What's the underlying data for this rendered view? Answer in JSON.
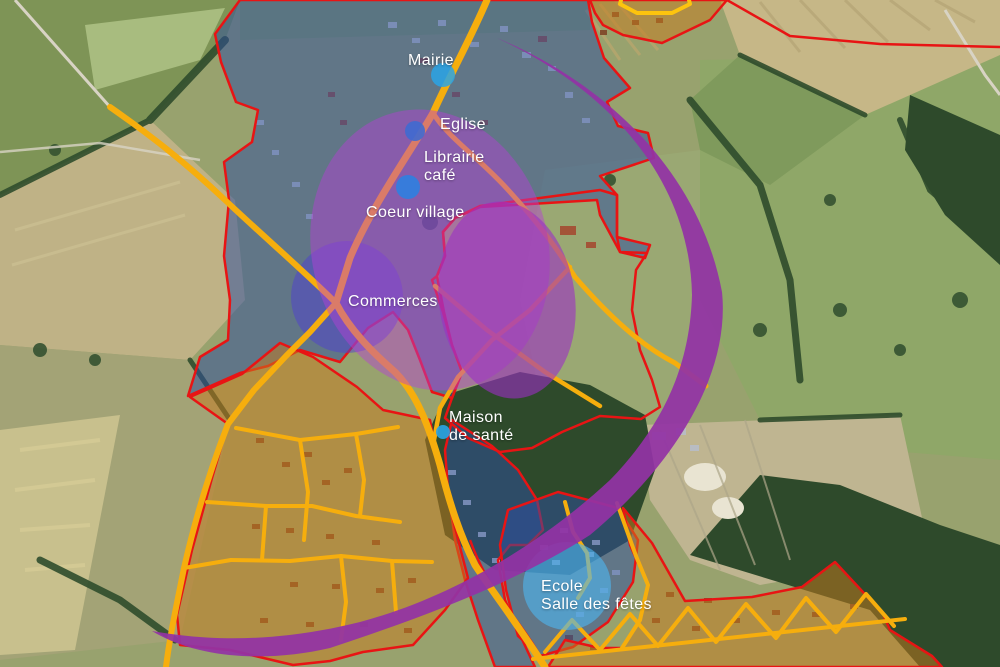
{
  "map": {
    "description": "Aerial urban-planning map of a village centre with zoning overlays",
    "labels": {
      "mairie": "Mairie",
      "eglise": "Eglise",
      "librairie_line1": "Librairie",
      "librairie_line2": "café",
      "coeur_village": "Coeur village",
      "commerces": "Commerces",
      "maison_line1": "Maison",
      "maison_line2": "de santé",
      "ecole_line1": "Ecole",
      "ecole_line2": "Salle des fêtes"
    },
    "colors": {
      "zone_outline_red": "#e81414",
      "existing_urban_blue": "#2e4fa0",
      "future_urban_orange": "#c8791c",
      "road_overlay_yellow": "#f6ae0d",
      "focus_purple": "#a833cc",
      "arc_purple": "#9233a5",
      "poi_blue": "#2aa4e6",
      "commerces_circle_blue": "#5040cf",
      "label_white": "#ffffff"
    }
  }
}
